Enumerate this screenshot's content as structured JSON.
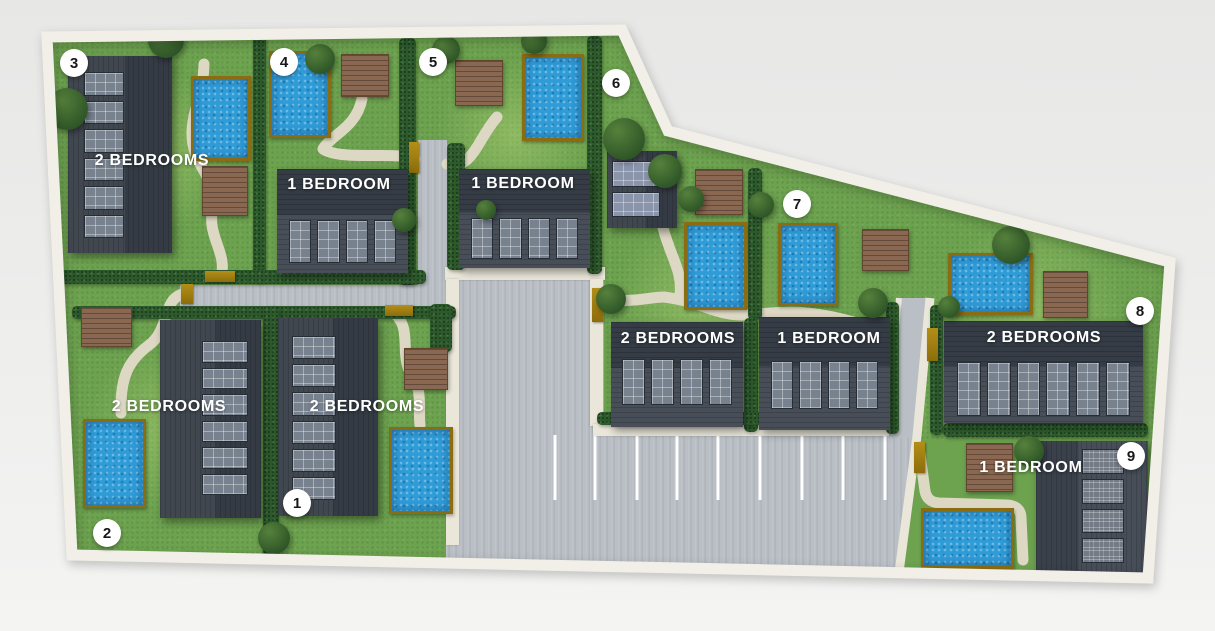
{
  "site": {
    "villas": [
      {
        "number": "1",
        "label": "2 BEDROOMS"
      },
      {
        "number": "2",
        "label": "2 BEDROOMS"
      },
      {
        "number": "3",
        "label": "2 BEDROOMS"
      },
      {
        "number": "4",
        "label": "1 BEDROOM"
      },
      {
        "number": "5",
        "label": "1 BEDROOM"
      },
      {
        "number": "6",
        "label": "2 BEDROOMS"
      },
      {
        "number": "7",
        "label": "1 BEDROOM"
      },
      {
        "number": "8",
        "label": "2 BEDROOMS"
      },
      {
        "number": "9",
        "label": "1 BEDROOM"
      }
    ],
    "colors": {
      "background": "#e9e9e7",
      "boundary_walkway": "#f1efe8",
      "grass": "#6da24f",
      "hedge": "#2d5a2d",
      "road": "#b9bfc5",
      "walkway": "#eae6d9",
      "garden_path": "#ddd8c3",
      "pool_water": "#2f9cd8",
      "pool_frame": "#8a6c12",
      "deck": "#8a6750",
      "roof_dark": "#353c45",
      "roof_light": "#474e58",
      "skylight": "#78828f",
      "gate": "#9c7b0e",
      "badge_bg": "#ffffff",
      "badge_text": "#17181a",
      "label_text": "#ffffff"
    }
  }
}
